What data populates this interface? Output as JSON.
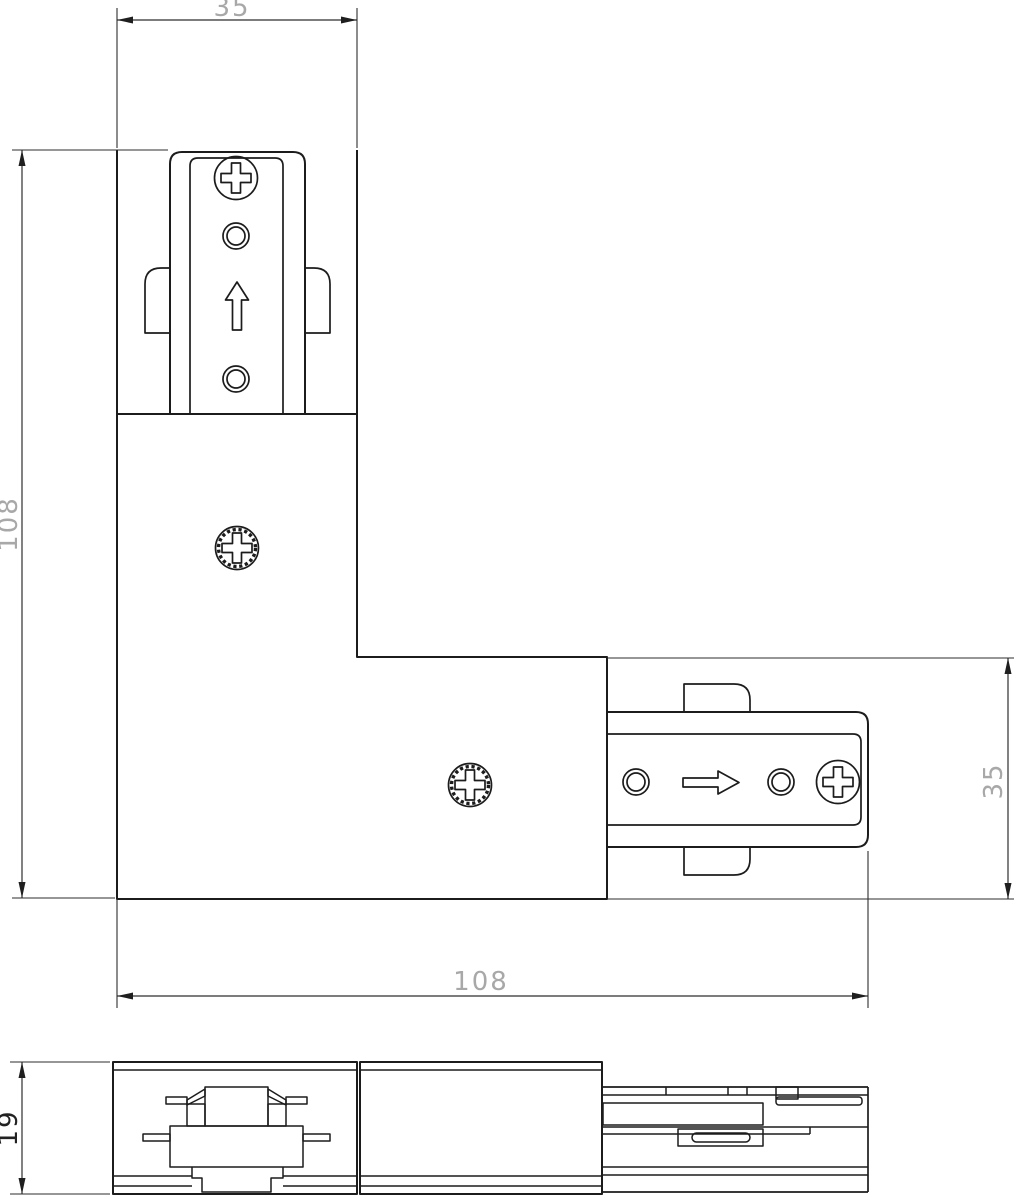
{
  "dims": {
    "top_width": "35",
    "left_height": "108",
    "right_height": "35",
    "bottom_width": "108",
    "profile_height": "19"
  },
  "colors": {
    "background": "#ffffff",
    "object_line": "#1c1c1c",
    "dim_line": "#2e2e2e",
    "dim_text": "#a8a8a8",
    "dim_text_dark": "#222222"
  },
  "icons": {
    "phillips_screw": "phillips-screw-icon",
    "knurled_phillips_screw": "knurled-screw-icon",
    "contact_hole": "contact-hole-icon",
    "insert_arrow_up": "direction-arrow-up-icon",
    "insert_arrow_right": "direction-arrow-right-icon"
  }
}
